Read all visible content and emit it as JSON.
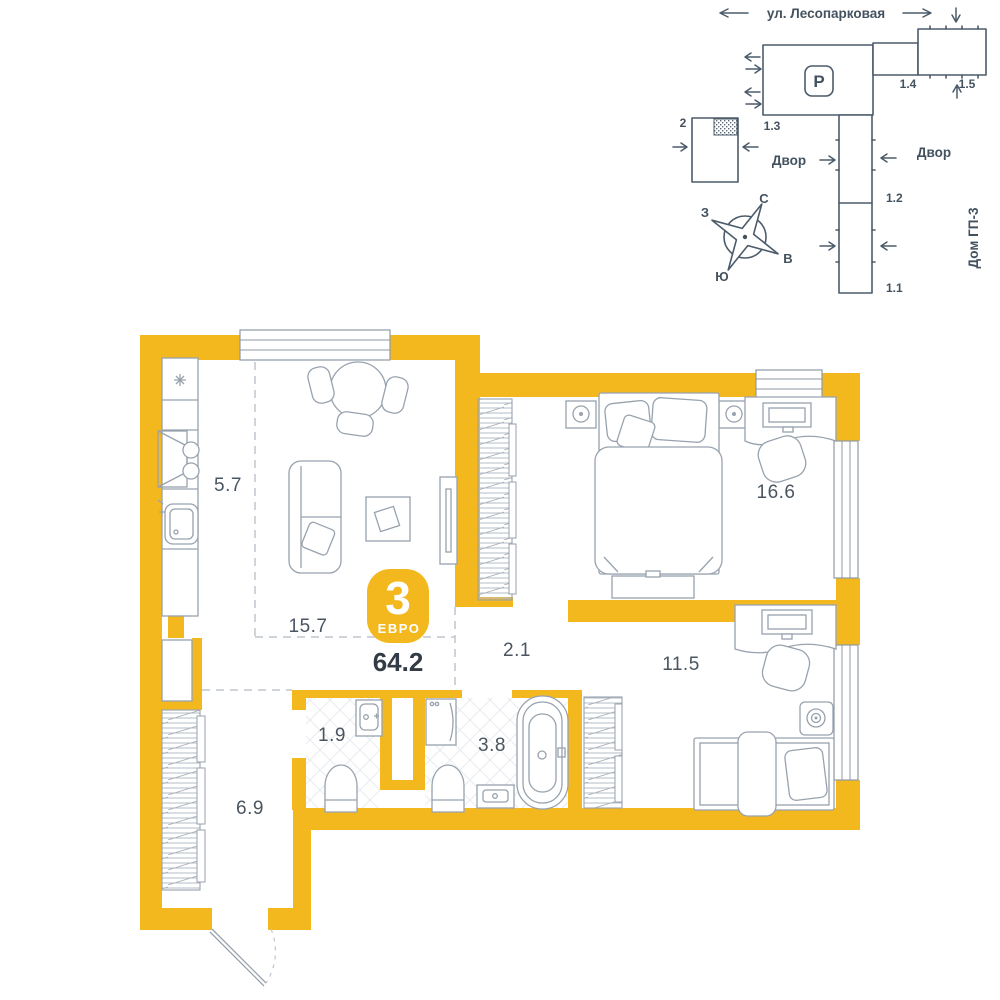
{
  "site_plan": {
    "street": "ул. Лесопарковая",
    "parking": "P",
    "buildings": {
      "b2": "2",
      "b11": "1.1",
      "b12": "1.2",
      "b13": "1.3",
      "b14": "1.4",
      "b15": "1.5"
    },
    "courtyard_left": "Двор",
    "courtyard_right": "Двор",
    "neighbor_house": "Дом ГП-3",
    "compass": {
      "n": "С",
      "s": "Ю",
      "w": "З",
      "e": "В"
    }
  },
  "floor_plan": {
    "badge": {
      "rooms": "3",
      "type": "ЕВРО",
      "total_area": "64.2"
    },
    "rooms": [
      {
        "name": "kitchen",
        "area": "5.7"
      },
      {
        "name": "living-room",
        "area": "15.7"
      },
      {
        "name": "bedroom",
        "area": "16.6"
      },
      {
        "name": "hall",
        "area": "2.1"
      },
      {
        "name": "bedroom-2",
        "area": "11.5"
      },
      {
        "name": "wc",
        "area": "1.9"
      },
      {
        "name": "bathroom",
        "area": "3.8"
      },
      {
        "name": "hallway",
        "area": "6.9"
      }
    ]
  },
  "colors": {
    "wall_yellow": "#F4B81F",
    "site_slate": "#4C5B6A",
    "furniture_gray": "#98A2AE",
    "text_dark": "#333B46",
    "label_gray": "#4A5560"
  }
}
